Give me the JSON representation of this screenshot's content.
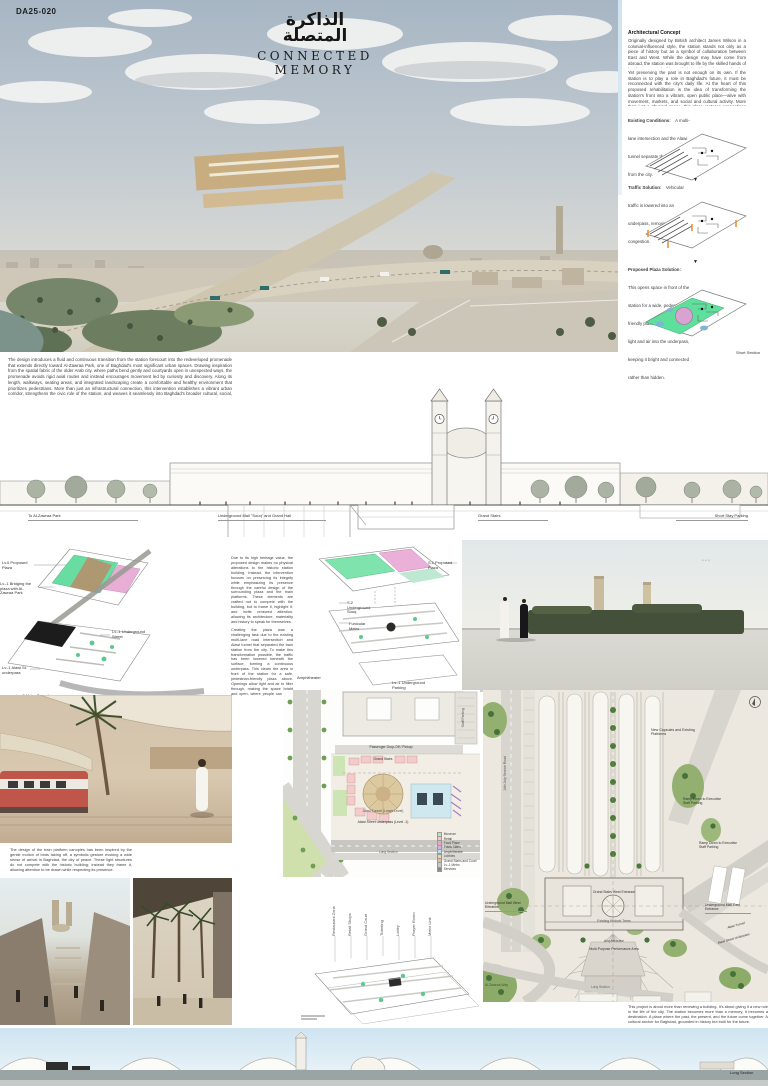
{
  "code": "DA25-020",
  "header": {
    "arabic_line1": "الذاكرة",
    "arabic_line2": "المتصلة",
    "title": "CONNECTED MEMORY"
  },
  "icons": {
    "down_arrow": "▼",
    "north": "N"
  },
  "concept": {
    "heading": "Architectural Concept",
    "p1": "Originally designed by British architect James Wilson in a colonial-influenced style, the station stands not only as a piece of history but as a symbol of collaboration between East and West. While the design may have come from abroad, the station was brought to life by the skilled hands of local master builders (الاسطوات), who used their craftsmanship and knowledge to transform plans into reality.",
    "p2": "Yet preserving the past is not enough on its own. If the station is to play a role in Baghdad's future, it must be reconnected with the city's daily life. At the heart of this proposed rehabilitation is the idea of transforming the station's front into a vibrant, open public place—alive with movement, markets, and social and cultural activity. More than just a physical space, this place restores connections with the surroundings. It brings the station back into dialogue with nearby landmarks such as the Umm Al-Tubul Mosque, Al-Zawraa Park, and the emerging skyline of Baghdad. It becomes a shared space—a pause in the city's rhythm—where history and modern life can meet."
  },
  "solutions": [
    {
      "title": "Existing Conditions:",
      "text": "A multi-lane intersection and the Alawi tunnel separate the train station from the city."
    },
    {
      "title": "Traffic Solution:",
      "text": "Vehicular traffic is lowered into an underpass, removing surface congestion."
    },
    {
      "title": "Proposed Plaza Solution:",
      "text": "This opens space in front of the station for a wide, pedestrian-friendly plaza. Openings bring light and air into the underpass, keeping it bright and connected rather than hidden."
    }
  ],
  "short_section": {
    "label": "Short Section",
    "intro": "The design introduces a fluid and continuous transition from the station forecourt into the redeveloped promenade that extends directly toward Al-Zawraa Park, one of Baghdad's most significant urban spaces. Drawing inspiration from the spatial fabric of the older Arab city, where paths bend gently and courtyards open in unexpected ways, the promenade avoids rigid axial routes and instead encourages movement led by curiosity and discovery. Along its length, walkways, seating areas, and integrated landscaping create a comfortable and healthy environment that prioritizes pedestrians. More than just an infrastructural connection, this intervention establishes a vibrant urban corridor, strengthens the civic role of the station, and weaves it seamlessly into Baghdad's broader cultural, social, and recreational life.",
    "callouts": [
      "To Al-Zawraa Park",
      "Underground Mall \"Souq\" and Grand Hall",
      "Grand Stairs",
      "Short Stay Parking"
    ]
  },
  "axon_left": {
    "labels": [
      "Lv.0 Proposed Plaza",
      "Lv.-1 Bridging the plaza with Al-Zawraa Park",
      "Lv.-1 Underground Street",
      "Lv.-1 Alawi St. underpass",
      "Lv.-2 Metro Tunnel"
    ]
  },
  "narrative": {
    "p1": "Due to its high heritage value, the proposed design makes no physical alterations to the historic station building. Instead, the intervention focuses on preserving its integrity while emphasizing its presence through the careful design of the surrounding plaza and the main platforms. These elements are crafted not to compete with the building, but to frame it, highlight it, and invite renewed attention, allowing its architecture, materiality and history to speak for themselves.",
    "p2": "Creating the plaza was a challenging task due to the existing multi-lane road intersection and Alawi tunnel that separated the train station from the city. To make this transformation possible, the traffic has been lowered beneath the surface, forming a continuous underpass. This clears the area in front of the station for a safe, pedestrian-friendly plaza above. Openings allow light and air to filter through, making the space bright and open, where people can move freely, gather, and experience the station in new ways.",
    "p3": "Beneath this plaza lies an underground Souq (سوق) that functions as both a communal space and a mobility hub. It connects seamlessly to the future metro lines, bus routes, and car access points—bringing together the city's various transportation systems in one integrated level. Inspired by vaulted markets, the hall rises with a striking view of the station, deliberately emphasizing the architecture of the old building and turning each arrival into a moment of architectural drama, memory and civic presence.",
    "p4": "The underground market is designed to remain visually concealed from the plaza, ensuring that the openness of the surface is preserved. Hidden beneath the ground, it reveals itself gradually—maintaining the project's visual connection to the city above while enhancing the experience of spatial discovery."
  },
  "axon_center": {
    "labels": [
      "S.1 Proposed Plaza",
      "S.2 Underground Souq",
      "Funicular Metro",
      "Amphitheater",
      "Lv.-1 Underground Parking"
    ]
  },
  "platform_caption": "The design of the train platform canopies has been inspired by the gentle motion of birds taking off, a symbolic gesture evoking a wide sense of arrival in Baghdad, the city of peace. These light structures do not compete with the historic building; instead they frame it, allowing attention to be drawn while respecting its presence.",
  "souq_plan": {
    "side_label": "Underground Souq Level",
    "labels": [
      "Passenger Drop-Off / Pickup",
      "Grand Stairs",
      "Staff Parking",
      "Alawi Tunnel (Lower Level)",
      "Alawi Street Underpass (Level -1)",
      "Long Section"
    ],
    "legend": [
      {
        "label": "Museum",
        "color": "#bfe3b2"
      },
      {
        "label": "Retail",
        "color": "#f3c9cf"
      },
      {
        "label": "Food Place",
        "color": "#eaa9b8"
      },
      {
        "label": "Plaza Stairs",
        "color": "#cdb6dd"
      },
      {
        "label": "Amphitheatre",
        "color": "#bcdfe8"
      },
      {
        "label": "Lobbies",
        "color": "#f4d2a6"
      },
      {
        "label": "Grand Stairs and Court",
        "color": "#d9c49a"
      },
      {
        "label": "Lv.-1 Metro",
        "color": "#c9c9c9"
      },
      {
        "label": "Services",
        "color": "#8b8b8b"
      }
    ]
  },
  "program_axon": {
    "labels": [
      "Restaurant Zone",
      "Retail Shops",
      "Grand Court",
      "Ticketing",
      "Lobby",
      "Prayer Room",
      "Metro Link"
    ]
  },
  "ground_plan": {
    "side_label": "Ground Floor Plan",
    "labels": [
      "New Capsules and Existing Platforms",
      "Ramp Down to Executive Staff Parking",
      "Underground Mall West Entrance",
      "Underground Mall East Entrance",
      "Grand Stairs West Entrance",
      "Existing Historic Trees",
      "Amphitheatre",
      "Multi-Purpose Performance Area",
      "14th July Service Road",
      "Alawi Tunnel",
      "Alawi Street Underpass",
      "Al-Zawraa Way",
      "Long Section"
    ]
  },
  "closing": "This project is about more than renewing a building. It's about giving it a new role in the life of the city. The station becomes more than a memory, it becomes a destination. A place where the past, the present, and the future come together. A cultural anchor for Baghdad, grounded in history but built for the future.",
  "long_section_label": "Long Section"
}
